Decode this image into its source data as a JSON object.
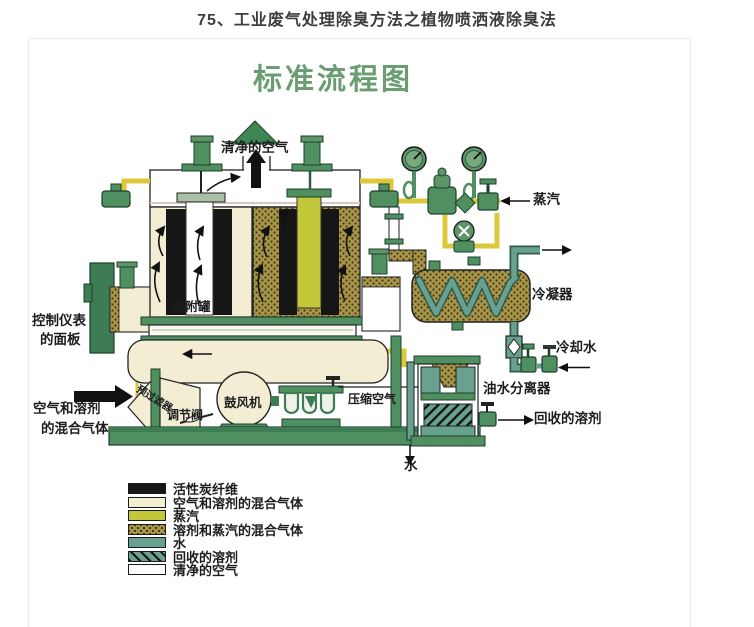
{
  "page": {
    "title": "75、工业废气处理除臭方法之植物喷洒液除臭法"
  },
  "diagram": {
    "title": "标准流程图",
    "labels": {
      "clean_air": "清净的空气",
      "adsorption_tank": "吸附罐",
      "control_panel_line1": "控制仪表",
      "control_panel_line2": "的面板",
      "inlet_line1": "空气和溶剂",
      "inlet_line2": "的混合气体",
      "prefilter": "预过滤器",
      "regulating_valve": "调节阀",
      "blower": "鼓风机",
      "compressed_air": "压缩空气",
      "steam": "蒸汽",
      "condenser": "冷凝器",
      "cooling_water": "冷却水",
      "oil_water_separator": "油水分离器",
      "recovered_solvent": "回收的溶剂",
      "water": "水"
    }
  },
  "legend": {
    "items": [
      {
        "label": "活性炭纤维",
        "color": "#161616",
        "style": "solid"
      },
      {
        "label": "空气和溶剂的混合气体",
        "color": "#f4eed2",
        "style": "solid"
      },
      {
        "label": "蒸汽",
        "color": "#c3c73a",
        "style": "solid"
      },
      {
        "label": "溶剂和蒸汽的混合气体",
        "color": "#a8964a",
        "style": "dotted"
      },
      {
        "label": "水",
        "color": "#68a18f",
        "style": "solid"
      },
      {
        "label": "回收的溶剂",
        "color": "#68a18f",
        "style": "hatched"
      },
      {
        "label": "清净的空气",
        "color": "#ffffff",
        "style": "solid"
      }
    ]
  },
  "colors": {
    "diagram_title_green": "#6a9e72",
    "equipment_green": "#4f8f60",
    "panel_dark_green": "#3e7c54",
    "pipe_yellow": "#ddc83c",
    "steam_yellow": "#c3c73a",
    "mixture_cream": "#f3eed3",
    "solvent_steam_olive": "#a8964a",
    "water_teal": "#68a18f",
    "carbon_black": "#161616"
  }
}
